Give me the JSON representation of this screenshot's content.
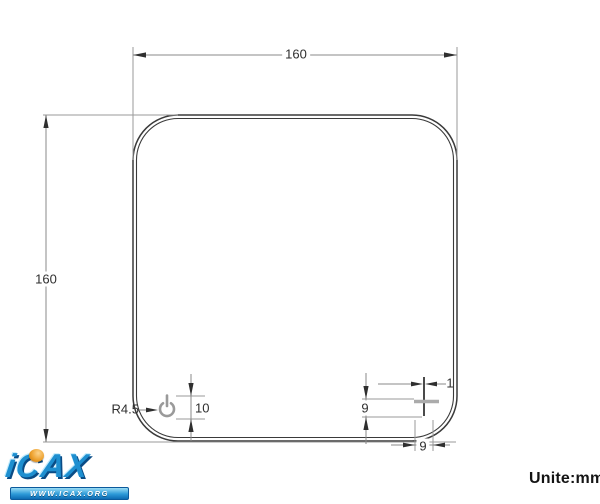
{
  "page": {
    "units_label": "Unite:mm"
  },
  "dimensions": {
    "top_width": "160",
    "left_height": "160",
    "power_offset": "10",
    "corner_radius": "R4.5",
    "slot_height": "9",
    "slot_line_width": "1",
    "slot_width": "9"
  },
  "icons": {
    "power_button": "power-icon",
    "cross_slot": "cross-slot-feature"
  },
  "logo": {
    "brand": "iCAX",
    "website": "WWW.ICAX.ORG"
  },
  "colors": {
    "outline": "#3a3a3a",
    "dimension_line": "#8a8a8a",
    "extension_line": "#9a9a9a",
    "arrowhead": "#2f2f2f",
    "logo_blue": "#1e8fd0",
    "logo_orange": "#e8961e"
  }
}
